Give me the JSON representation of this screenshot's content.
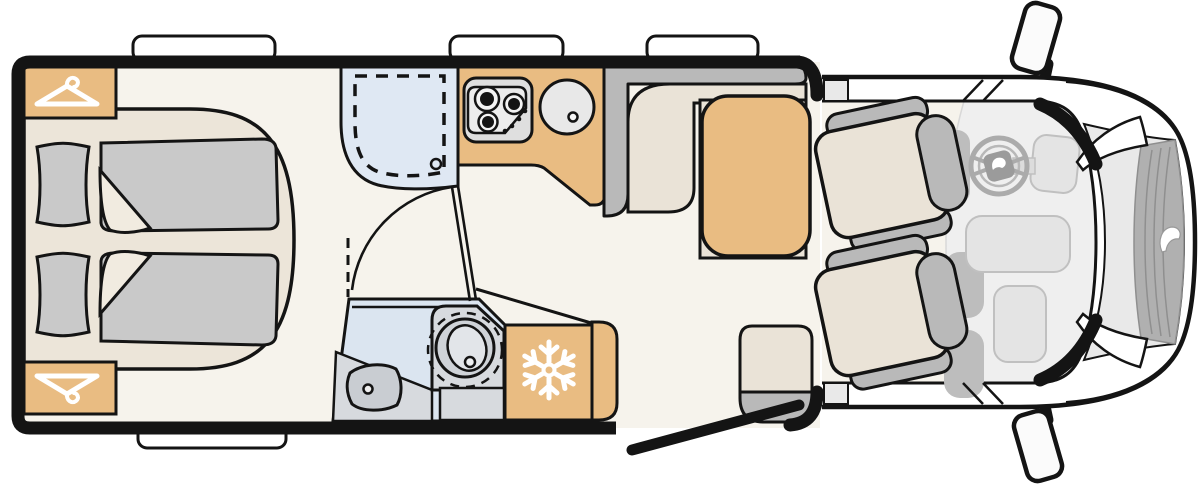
{
  "plan": {
    "title": "Motorhome floor plan, top view",
    "type": "vehicle-floorplan",
    "areas": {
      "bedroom": {
        "label": "rear twin beds",
        "beds": 2,
        "pillows": 2,
        "wardrobes": 2
      },
      "shower": {
        "label": "shower cubicle",
        "tray": "dashed outline",
        "drain": true
      },
      "kitchen": {
        "label": "kitchenette",
        "hob_burners": 3,
        "sink": true
      },
      "bathroom": {
        "label": "washroom",
        "toilet": true,
        "washbasin": true
      },
      "fridge": {
        "label": "refrigerator",
        "icon": "snowflake-icon"
      },
      "dinette": {
        "label": "dinette",
        "table": true,
        "bench": "L-shaped"
      },
      "entry": {
        "label": "entry door shown open",
        "step_unit": true
      },
      "cab": {
        "label": "driver cab",
        "swivel_seats": 2,
        "steering_wheel": true,
        "side_mirrors": 2,
        "grille": true
      }
    },
    "openings": {
      "windows_top": 3,
      "windows_bottom": 1,
      "entry_door_open": true
    },
    "palette": {
      "floor": "#f6f3ec",
      "wall": "#141414",
      "wood": "#e9bc82",
      "platform": "#ece5d9",
      "bedding": "#c9c9c9",
      "bedding_fold": "#f1ebe0",
      "shower_blue": "#dfe8f3",
      "bath_blue": "#dbe5f0",
      "fixture_gray": "#d7dade",
      "fixture_gray_dark": "#c9cdd2",
      "bench_gray": "#b9b9b9",
      "cushion": "#eae3d7",
      "cab_floor": "#efefef",
      "dash_gray": "#e4e4e4",
      "hood": "#e9e9e9",
      "grille": "#b0b0b0",
      "glass": "#ffffff",
      "icon_white": "#ffffff"
    }
  }
}
